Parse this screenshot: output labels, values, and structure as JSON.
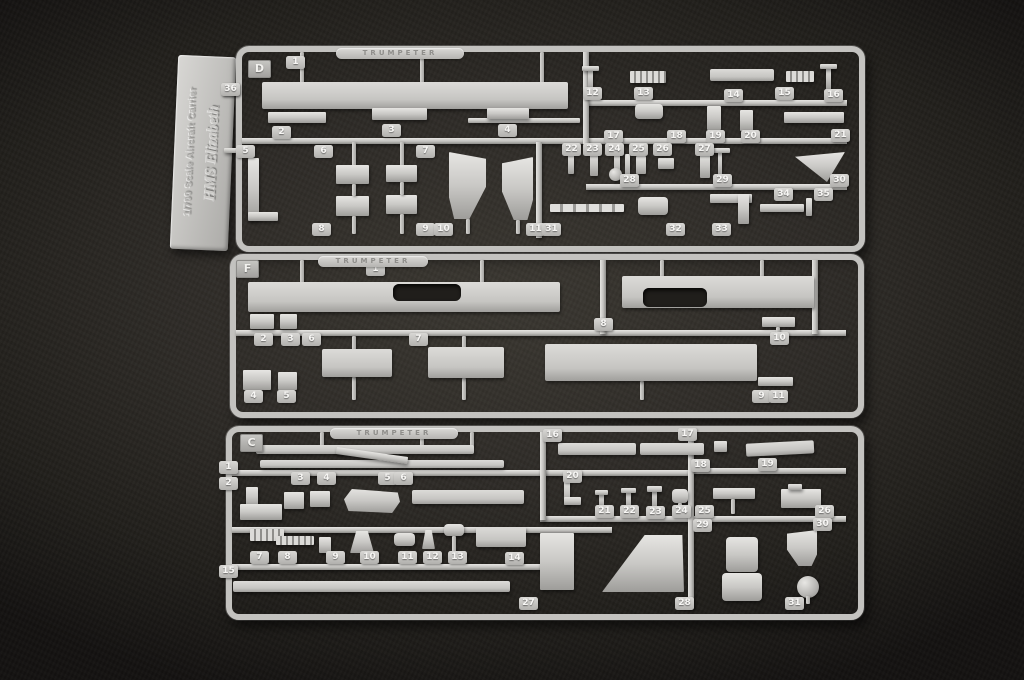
{
  "palette": {
    "background": "#2e2b27",
    "vignette": "#131110",
    "plastic": "#c9c8c5",
    "tab_number_color": "#f7f6f4"
  },
  "label_tag": {
    "line1": "1/700 Scale Aircraft Carrier",
    "line2": "HMS Elizabeth"
  },
  "sprues": [
    {
      "letter": "D",
      "stamp_text": "TRUMPETER",
      "frame": {
        "x": 236,
        "y": 46,
        "w": 617,
        "h": 194
      },
      "letter_box": {
        "x": 248,
        "y": 60
      },
      "stamp": {
        "x": 336,
        "y": 48,
        "w": 128
      },
      "rails": [
        [
          "h",
          242,
          138,
          344
        ],
        [
          "h",
          586,
          100,
          261
        ],
        [
          "h",
          586,
          138,
          261
        ],
        [
          "h",
          586,
          184,
          261
        ],
        [
          "v",
          583,
          52,
          92
        ],
        [
          "v",
          536,
          142,
          96
        ]
      ],
      "pieces": [
        [
          "stub",
          300,
          52,
          4,
          31
        ],
        [
          "stub",
          420,
          52,
          4,
          31
        ],
        [
          "stub",
          540,
          52,
          4,
          31
        ],
        [
          "deck",
          262,
          82,
          306,
          27
        ],
        [
          "rect",
          468,
          118,
          112,
          5
        ],
        [
          "rect",
          268,
          112,
          58,
          11
        ],
        [
          "rect",
          372,
          108,
          55,
          12
        ],
        [
          "rect",
          487,
          108,
          42,
          11
        ],
        [
          "stub",
          352,
          142,
          4,
          24
        ],
        [
          "stub",
          400,
          142,
          4,
          24
        ],
        [
          "rect",
          336,
          165,
          33,
          19
        ],
        [
          "rect",
          386,
          165,
          31,
          17
        ],
        [
          "rect",
          336,
          196,
          33,
          20
        ],
        [
          "rect",
          386,
          195,
          31,
          19
        ],
        [
          "stub",
          352,
          184,
          4,
          12
        ],
        [
          "stub",
          400,
          182,
          4,
          13
        ],
        [
          "stub",
          352,
          216,
          4,
          18
        ],
        [
          "stub",
          400,
          214,
          4,
          20
        ],
        [
          "rect",
          248,
          158,
          11,
          62
        ],
        [
          "rect",
          248,
          212,
          30,
          9
        ],
        [
          "wedge-l",
          449,
          152,
          37,
          67
        ],
        [
          "wedge-r",
          502,
          157,
          31,
          63
        ],
        [
          "stub",
          466,
          219,
          4,
          15
        ],
        [
          "stub",
          516,
          220,
          4,
          14
        ],
        [
          "rect",
          588,
          68,
          5,
          22
        ],
        [
          "rect",
          582,
          66,
          17,
          5
        ],
        [
          "comb",
          630,
          71,
          36,
          12
        ],
        [
          "deck",
          710,
          69,
          64,
          12
        ],
        [
          "comb",
          786,
          71,
          28,
          11
        ],
        [
          "rect",
          826,
          66,
          5,
          24
        ],
        [
          "rect",
          820,
          64,
          17,
          5
        ],
        [
          "pod",
          635,
          104,
          28,
          15
        ],
        [
          "rect",
          707,
          106,
          14,
          24
        ],
        [
          "rect",
          740,
          110,
          13,
          21
        ],
        [
          "rect",
          784,
          112,
          60,
          11
        ],
        [
          "rect",
          568,
          154,
          6,
          20
        ],
        [
          "rect",
          590,
          152,
          8,
          24
        ],
        [
          "rect",
          614,
          152,
          6,
          24
        ],
        [
          "circle",
          609,
          168,
          13,
          13
        ],
        [
          "rect",
          636,
          156,
          10,
          18
        ],
        [
          "rect",
          658,
          158,
          16,
          11
        ],
        [
          "rect",
          700,
          154,
          10,
          24
        ],
        [
          "rect",
          625,
          154,
          5,
          22
        ],
        [
          "rect",
          718,
          150,
          4,
          26
        ],
        [
          "rect",
          712,
          148,
          18,
          5
        ],
        [
          "tri",
          795,
          152,
          50,
          30
        ],
        [
          "mast",
          550,
          204,
          74,
          8
        ],
        [
          "pod",
          638,
          197,
          30,
          18
        ],
        [
          "rect",
          710,
          194,
          42,
          9
        ],
        [
          "rect",
          738,
          194,
          11,
          30
        ],
        [
          "rect",
          760,
          204,
          44,
          8
        ],
        [
          "rect",
          806,
          198,
          6,
          18
        ],
        [
          "rect",
          222,
          90,
          16,
          5
        ],
        [
          "rect",
          224,
          148,
          14,
          5
        ]
      ],
      "tabs": [
        [
          "1",
          286,
          56
        ],
        [
          "2",
          272,
          126
        ],
        [
          "3",
          382,
          124
        ],
        [
          "4",
          498,
          124
        ],
        [
          "5",
          236,
          145
        ],
        [
          "6",
          314,
          145
        ],
        [
          "7",
          416,
          145
        ],
        [
          "8",
          312,
          223
        ],
        [
          "9",
          416,
          223
        ],
        [
          "10",
          434,
          223
        ],
        [
          "11",
          526,
          223
        ],
        [
          "12",
          583,
          87
        ],
        [
          "13",
          634,
          87
        ],
        [
          "14",
          724,
          89
        ],
        [
          "15",
          775,
          87
        ],
        [
          "16",
          824,
          89
        ],
        [
          "17",
          604,
          130
        ],
        [
          "18",
          667,
          130
        ],
        [
          "19",
          706,
          130
        ],
        [
          "20",
          741,
          130
        ],
        [
          "21",
          831,
          129
        ],
        [
          "22",
          562,
          143
        ],
        [
          "23",
          583,
          143
        ],
        [
          "24",
          605,
          143
        ],
        [
          "25",
          629,
          143
        ],
        [
          "26",
          653,
          143
        ],
        [
          "27",
          695,
          143
        ],
        [
          "28",
          620,
          174
        ],
        [
          "29",
          713,
          174
        ],
        [
          "30",
          830,
          174
        ],
        [
          "31",
          542,
          223
        ],
        [
          "32",
          666,
          223
        ],
        [
          "33",
          712,
          223
        ],
        [
          "34",
          774,
          188
        ],
        [
          "35",
          814,
          188
        ],
        [
          "36",
          221,
          83
        ]
      ]
    },
    {
      "letter": "F",
      "stamp_text": "TRUMPETER",
      "frame": {
        "x": 230,
        "y": 254,
        "w": 622,
        "h": 152
      },
      "letter_box": {
        "x": 236,
        "y": 260
      },
      "stamp": {
        "x": 318,
        "y": 256,
        "w": 110
      },
      "rails": [
        [
          "h",
          236,
          330,
          610
        ],
        [
          "v",
          600,
          260,
          74
        ],
        [
          "v",
          812,
          260,
          74
        ]
      ],
      "pieces": [
        [
          "stub",
          300,
          260,
          4,
          24
        ],
        [
          "stub",
          480,
          260,
          4,
          24
        ],
        [
          "stub",
          660,
          260,
          4,
          18
        ],
        [
          "stub",
          760,
          260,
          4,
          18
        ],
        [
          "deck",
          248,
          282,
          312,
          30
        ],
        [
          "hole",
          393,
          284,
          68,
          17
        ],
        [
          "deck",
          622,
          276,
          192,
          32
        ],
        [
          "hole",
          643,
          288,
          64,
          19
        ],
        [
          "stub",
          352,
          336,
          4,
          15
        ],
        [
          "stub",
          462,
          336,
          4,
          13
        ],
        [
          "stub",
          352,
          377,
          4,
          23
        ],
        [
          "stub",
          462,
          378,
          4,
          22
        ],
        [
          "stub",
          640,
          381,
          4,
          19
        ],
        [
          "deck",
          322,
          349,
          70,
          28
        ],
        [
          "deck",
          428,
          347,
          76,
          31
        ],
        [
          "deck",
          545,
          344,
          212,
          37
        ],
        [
          "rect",
          250,
          314,
          24,
          15
        ],
        [
          "rect",
          280,
          314,
          17,
          15
        ],
        [
          "rect",
          243,
          370,
          28,
          20
        ],
        [
          "rect",
          278,
          372,
          19,
          18
        ],
        [
          "rect",
          762,
          317,
          33,
          10
        ],
        [
          "stub",
          776,
          327,
          4,
          8
        ],
        [
          "rect",
          758,
          377,
          35,
          9
        ]
      ],
      "tabs": [
        [
          "1",
          366,
          263
        ],
        [
          "2",
          254,
          333
        ],
        [
          "3",
          281,
          333
        ],
        [
          "6",
          302,
          333
        ],
        [
          "7",
          409,
          333
        ],
        [
          "8",
          594,
          318
        ],
        [
          "10",
          770,
          332
        ],
        [
          "4",
          244,
          390
        ],
        [
          "5",
          277,
          390
        ],
        [
          "9",
          752,
          390
        ],
        [
          "11",
          769,
          390
        ]
      ]
    },
    {
      "letter": "C",
      "stamp_text": "TRUMPETER",
      "frame": {
        "x": 226,
        "y": 426,
        "w": 626,
        "h": 182
      },
      "letter_box": {
        "x": 240,
        "y": 434
      },
      "stamp": {
        "x": 330,
        "y": 428,
        "w": 128
      },
      "rails": [
        [
          "h",
          232,
          470,
          460
        ],
        [
          "h",
          690,
          468,
          156
        ],
        [
          "h",
          232,
          527,
          380
        ],
        [
          "h",
          540,
          516,
          306
        ],
        [
          "h",
          232,
          564,
          310
        ],
        [
          "v",
          540,
          432,
          88
        ],
        [
          "v",
          688,
          432,
          176
        ]
      ],
      "pieces": [
        [
          "stub",
          320,
          432,
          4,
          15
        ],
        [
          "stub",
          420,
          432,
          4,
          15
        ],
        [
          "stub",
          470,
          432,
          4,
          15
        ],
        [
          "deck",
          256,
          445,
          218,
          9
        ],
        [
          "deck",
          260,
          460,
          244,
          8
        ],
        [
          "rect",
          336,
          452,
          72,
          7,
          8
        ],
        [
          "rect",
          246,
          487,
          12,
          20
        ],
        [
          "rect",
          240,
          504,
          42,
          16
        ],
        [
          "rect",
          284,
          492,
          20,
          17
        ],
        [
          "rect",
          310,
          491,
          20,
          16
        ],
        [
          "ship",
          344,
          488,
          56,
          25
        ],
        [
          "deck",
          412,
          490,
          112,
          14
        ],
        [
          "deck",
          558,
          443,
          78,
          12
        ],
        [
          "deck",
          640,
          443,
          64,
          12
        ],
        [
          "rect",
          714,
          441,
          13,
          11
        ],
        [
          "deck",
          746,
          442,
          68,
          13,
          -3
        ],
        [
          "rect",
          564,
          480,
          6,
          25
        ],
        [
          "rect",
          564,
          497,
          17,
          8
        ],
        [
          "rect",
          599,
          493,
          5,
          15
        ],
        [
          "rect",
          595,
          490,
          13,
          5
        ],
        [
          "rect",
          626,
          491,
          5,
          17
        ],
        [
          "rect",
          621,
          488,
          15,
          5
        ],
        [
          "rect",
          652,
          488,
          5,
          20
        ],
        [
          "rect",
          647,
          486,
          15,
          6
        ],
        [
          "pod",
          672,
          489,
          16,
          14
        ],
        [
          "stub",
          678,
          503,
          4,
          11
        ],
        [
          "rect",
          713,
          488,
          42,
          11
        ],
        [
          "stub",
          731,
          499,
          4,
          15
        ],
        [
          "rect",
          781,
          489,
          40,
          19
        ],
        [
          "rect",
          788,
          484,
          14,
          6
        ],
        [
          "comb",
          250,
          529,
          34,
          12
        ],
        [
          "comb",
          276,
          536,
          38,
          9
        ],
        [
          "rect",
          319,
          537,
          12,
          16
        ],
        [
          "funnel",
          350,
          531,
          24,
          22
        ],
        [
          "pod",
          394,
          533,
          21,
          13
        ],
        [
          "funnel",
          422,
          530,
          13,
          19
        ],
        [
          "pod",
          444,
          524,
          20,
          12
        ],
        [
          "stub",
          452,
          536,
          4,
          17
        ],
        [
          "deck",
          476,
          527,
          50,
          20
        ],
        [
          "deck",
          233,
          581,
          277,
          11
        ],
        [
          "rect",
          540,
          533,
          34,
          57
        ],
        [
          "ramp",
          602,
          535,
          82,
          57
        ],
        [
          "pod",
          726,
          537,
          32,
          35
        ],
        [
          "pod",
          722,
          573,
          40,
          28
        ],
        [
          "wedge-r",
          787,
          530,
          30,
          36
        ],
        [
          "circle",
          797,
          576,
          22,
          22
        ],
        [
          "stub",
          806,
          596,
          4,
          8
        ]
      ],
      "tabs": [
        [
          "1",
          219,
          461
        ],
        [
          "2",
          219,
          477
        ],
        [
          "3",
          291,
          472
        ],
        [
          "4",
          317,
          472
        ],
        [
          "5",
          378,
          472
        ],
        [
          "6",
          394,
          472
        ],
        [
          "7",
          250,
          551
        ],
        [
          "8",
          278,
          551
        ],
        [
          "9",
          326,
          551
        ],
        [
          "10",
          360,
          551
        ],
        [
          "11",
          398,
          551
        ],
        [
          "12",
          423,
          551
        ],
        [
          "13",
          448,
          551
        ],
        [
          "14",
          505,
          552
        ],
        [
          "15",
          219,
          565
        ],
        [
          "16",
          543,
          429
        ],
        [
          "17",
          678,
          428
        ],
        [
          "18",
          691,
          459
        ],
        [
          "19",
          758,
          458
        ],
        [
          "20",
          563,
          470
        ],
        [
          "21",
          595,
          505
        ],
        [
          "22",
          620,
          505
        ],
        [
          "23",
          646,
          506
        ],
        [
          "24",
          672,
          505
        ],
        [
          "25",
          695,
          505
        ],
        [
          "26",
          815,
          505
        ],
        [
          "27",
          519,
          597
        ],
        [
          "28",
          675,
          597
        ],
        [
          "29",
          693,
          519
        ],
        [
          "30",
          813,
          518
        ],
        [
          "31",
          785,
          597
        ]
      ]
    }
  ]
}
